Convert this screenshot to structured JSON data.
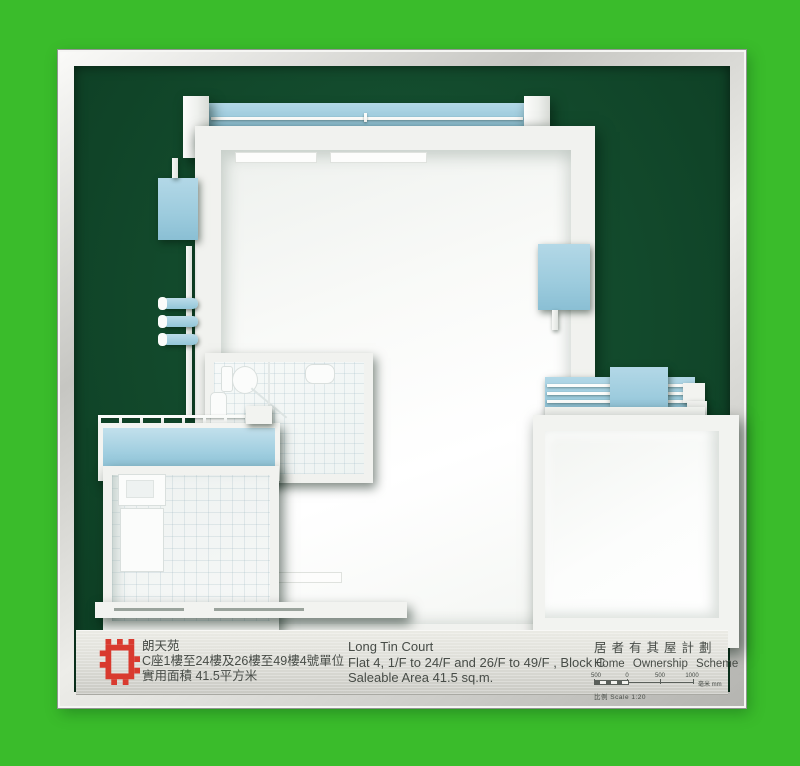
{
  "photo": {
    "background_color": "#3abc2b",
    "felt_color": "#134b2d",
    "frame_color": "#d9d9d5",
    "model_blue": "#9ccbdd",
    "model_white": "#f2f3f0"
  },
  "plate": {
    "logo_color": "#d93a2f",
    "project_name_zh": "朗天苑",
    "location_zh": "C座1樓至24樓及26樓至49樓4號單位",
    "area_zh": "實用面積 41.5平方米",
    "project_name_en": "Long Tin Court",
    "location_en": "Flat 4, 1/F to 24/F and 26/F to 49/F , Block C",
    "area_en": "Saleable Area 41.5 sq.m.",
    "scheme_zh": "居者有其屋計劃",
    "scheme_en": "Home Ownership Scheme",
    "scale_ticks": [
      "500",
      "0",
      "500",
      "1000"
    ],
    "scale_unit": "毫米 mm",
    "scale_text": "比例  Scale  1:20"
  }
}
